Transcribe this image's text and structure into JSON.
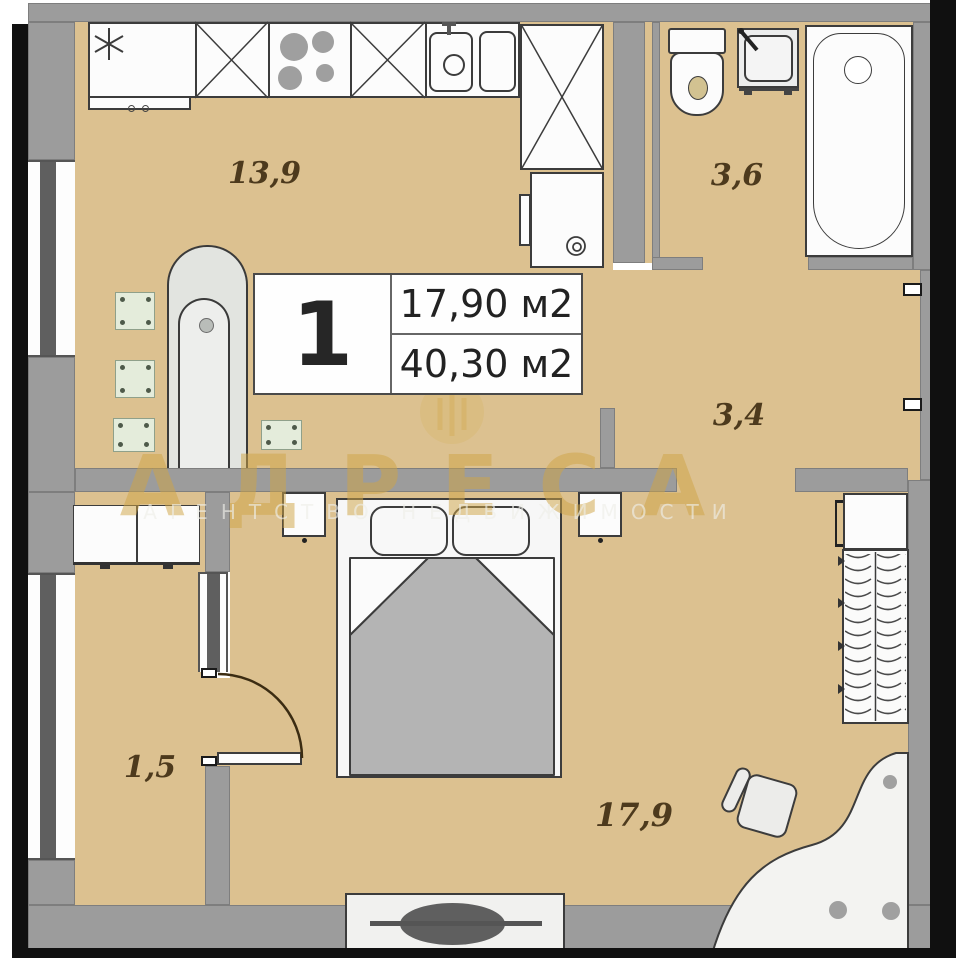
{
  "unit_card": {
    "rooms_count": "1",
    "living_area": "17,90 м2",
    "total_area": "40,30 м2"
  },
  "room_labels": {
    "kitchen_living": "13,9",
    "bathroom": "3,6",
    "hallway": "3,4",
    "balcony": "1,5",
    "bedroom": "17,9"
  },
  "watermark": {
    "title": "АДРЕСА",
    "subtitle": "АГЕНТСТВО НЕДВИЖИМОСТИ"
  },
  "colors": {
    "floor": "#dcc190",
    "wall": "#9c9c9c",
    "window_mullion": "#5f5f5f",
    "black_frame": "#101010",
    "label_brown": "#4d3a1d",
    "watermark_gold": "#cfa446",
    "blanket_gray": "#b4b4b4",
    "furniture_outline": "#3c3c3c"
  }
}
